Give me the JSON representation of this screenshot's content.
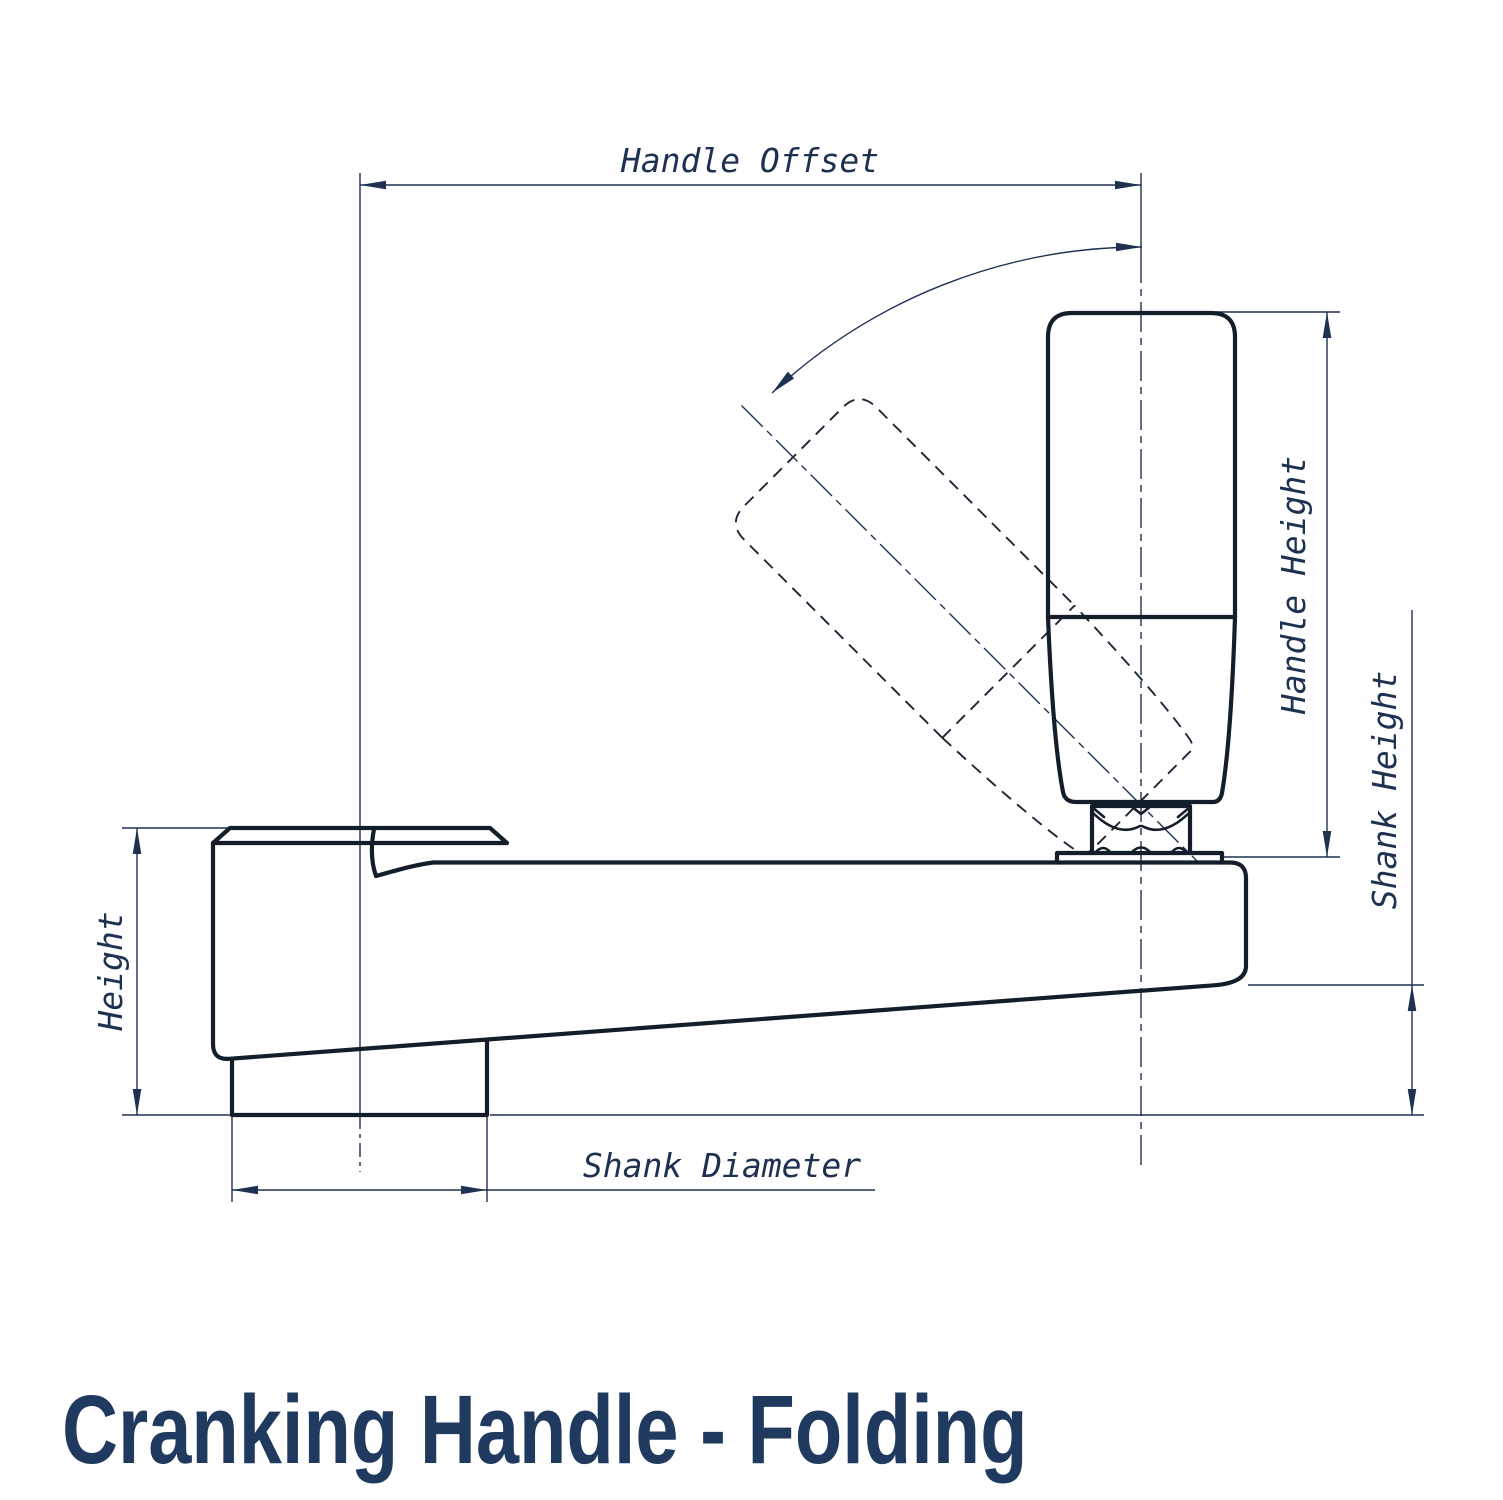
{
  "title": "Cranking Handle - Folding",
  "dimensions": {
    "handle_offset": "Handle Offset",
    "handle_height": "Handle Height",
    "shank_height": "Shank Height",
    "height": "Height",
    "shank_diameter": "Shank Diameter"
  },
  "colors": {
    "part_outline": "#141e2a",
    "dimension_ink": "#1e3151",
    "title_ink": "#1f3a5e",
    "background": "#ffffff"
  },
  "drawing": {
    "type": "engineering side view",
    "view_features": [
      "crank arm with hub",
      "shank",
      "upright folding grip handle",
      "folded handle shown dashed at 45 degrees",
      "hex nut and washer pivot",
      "fold rotation arc"
    ]
  }
}
